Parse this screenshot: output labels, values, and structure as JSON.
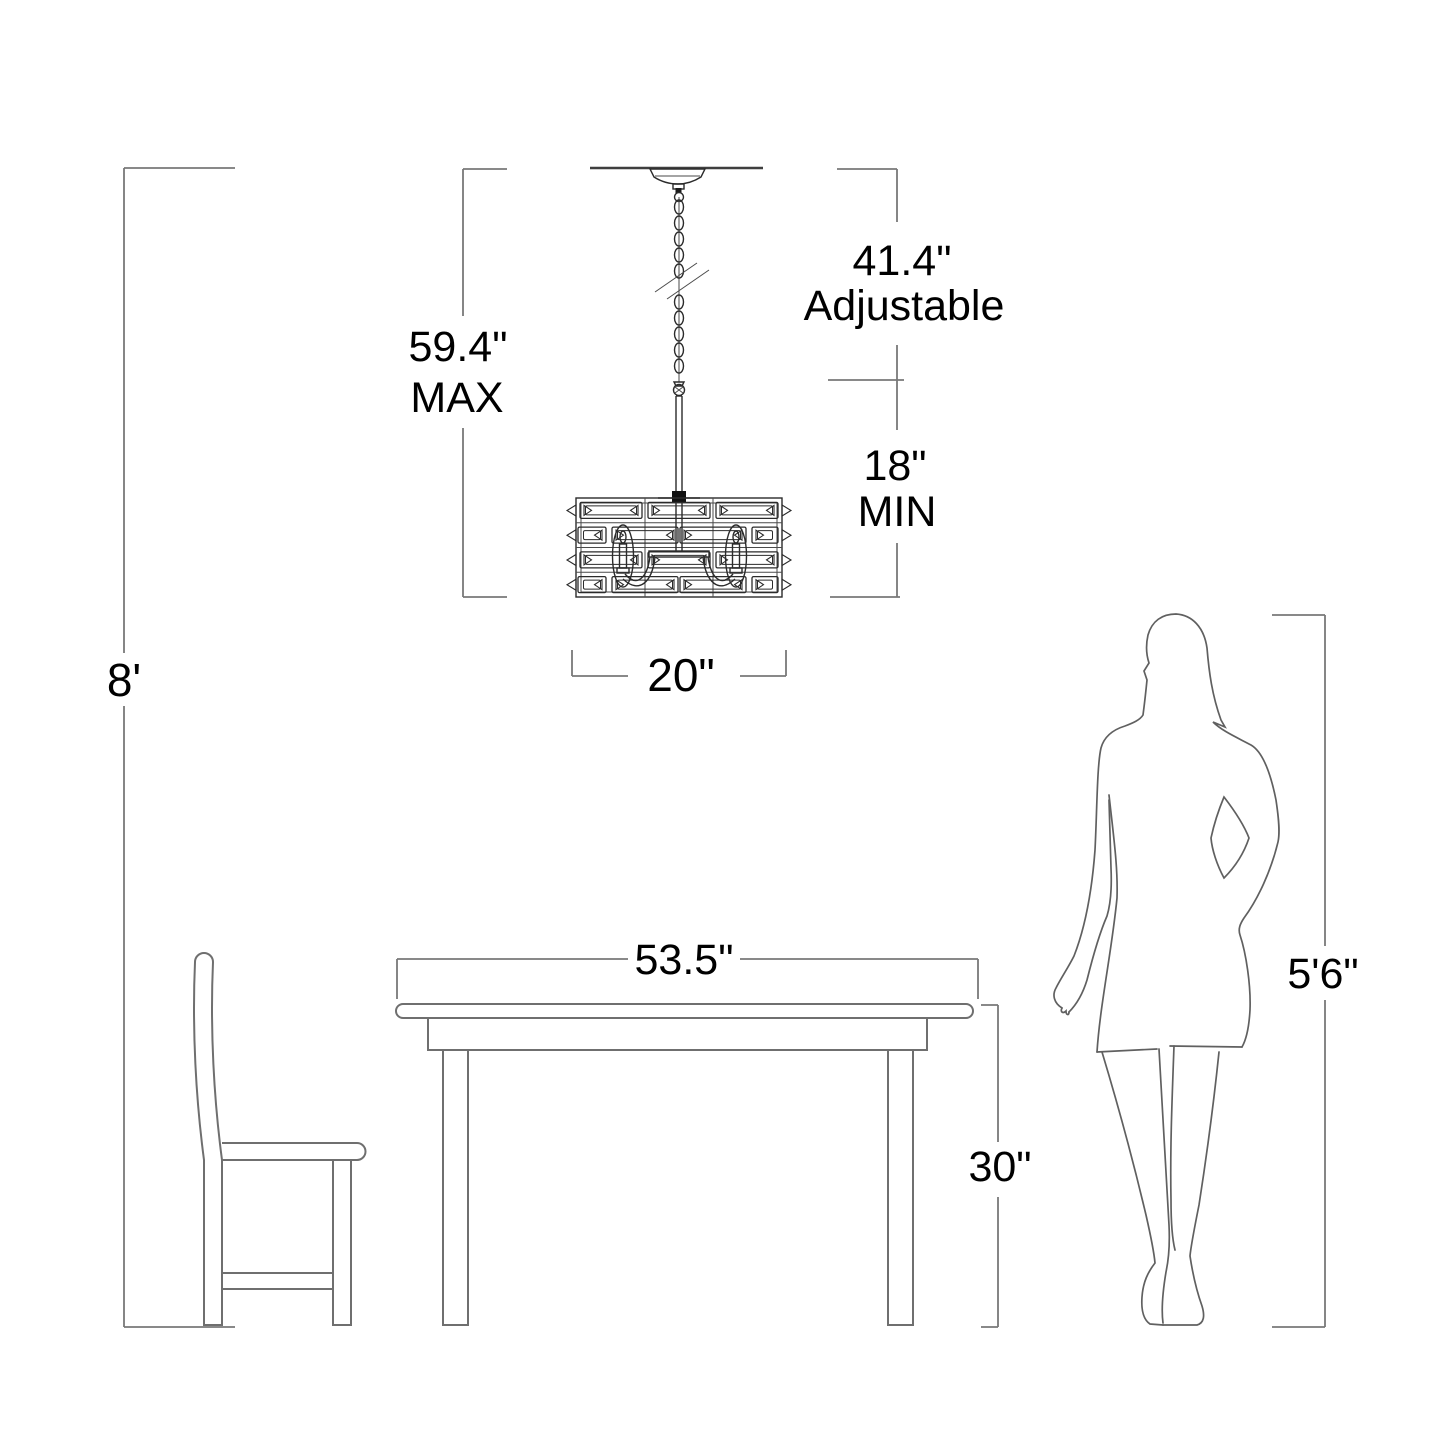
{
  "dimensions": {
    "ceiling_height": "8'",
    "fixture_max": "59.4\"",
    "fixture_max_label": "MAX",
    "adjustable": "41.4\"",
    "adjustable_label": "Adjustable",
    "min_height": "18\"",
    "min_label": "MIN",
    "fixture_width": "20\"",
    "table_width": "53.5\"",
    "table_height": "30\"",
    "person_height": "5'6\""
  },
  "colors": {
    "dimension_line": "#787878",
    "artwork_line": "#2b2b2b",
    "text": "#000000",
    "background": "#ffffff"
  }
}
